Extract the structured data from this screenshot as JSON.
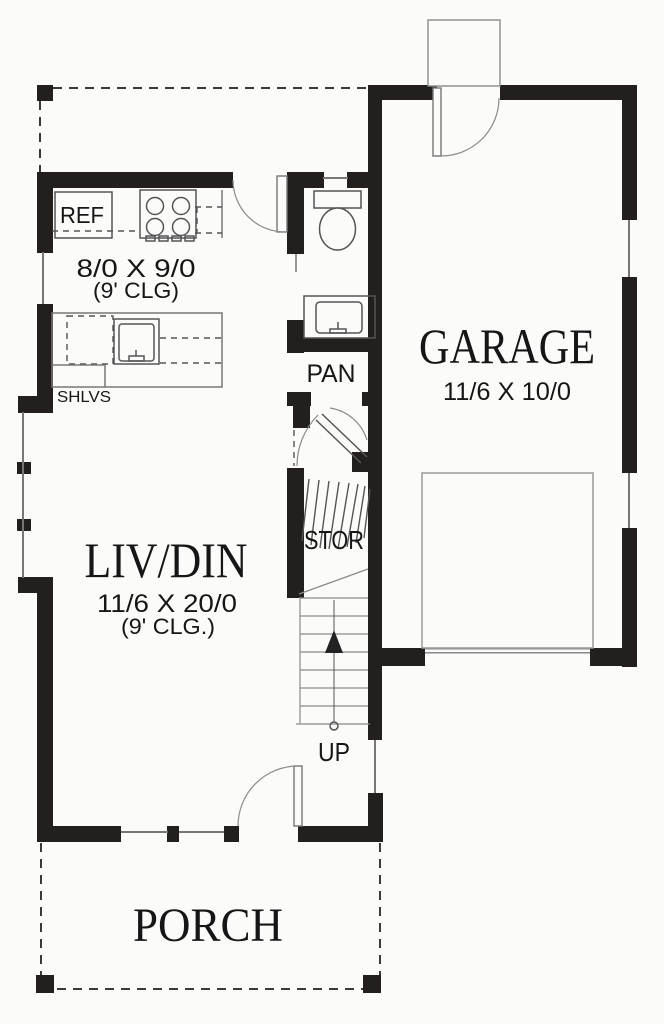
{
  "plan": {
    "kitchen": {
      "ref": "REF",
      "dim": "8/0 X 9/0",
      "clg": "(9' CLG)",
      "shelves": "SHLVS"
    },
    "living": {
      "name": "LIV/DIN",
      "dim": "11/6 X 20/0",
      "clg": "(9' CLG.)"
    },
    "garage": {
      "name": "GARAGE",
      "dim": "11/6 X 10/0"
    },
    "pantry": "PAN",
    "storage": "STOR",
    "stairs": "UP",
    "porch": "PORCH",
    "colors": {
      "wall": "#231f1d",
      "line": "#777777",
      "text": "#161616",
      "background": "#fbfbf9"
    }
  }
}
